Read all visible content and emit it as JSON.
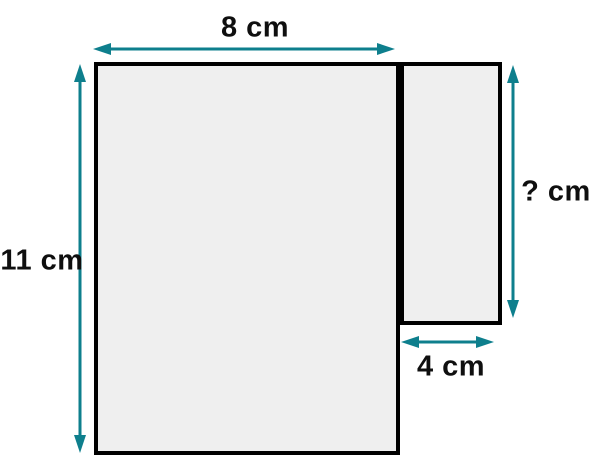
{
  "figure": {
    "type": "composite-rectangles-geometry-diagram",
    "labels": {
      "top_width": "8 cm",
      "left_height": "11 cm",
      "right_height": "? cm",
      "bottom_width": "4 cm"
    },
    "dimensions": {
      "unit": "cm",
      "large_rectangle": {
        "width": 8,
        "height": 11
      },
      "small_rectangle": {
        "width": 4,
        "height": "?"
      }
    },
    "colors": {
      "accent": "#0e7f8d",
      "shape_fill": "#efefef",
      "shape_border": "#000000",
      "text": "#0f0f0f",
      "background": "#ffffff"
    }
  }
}
